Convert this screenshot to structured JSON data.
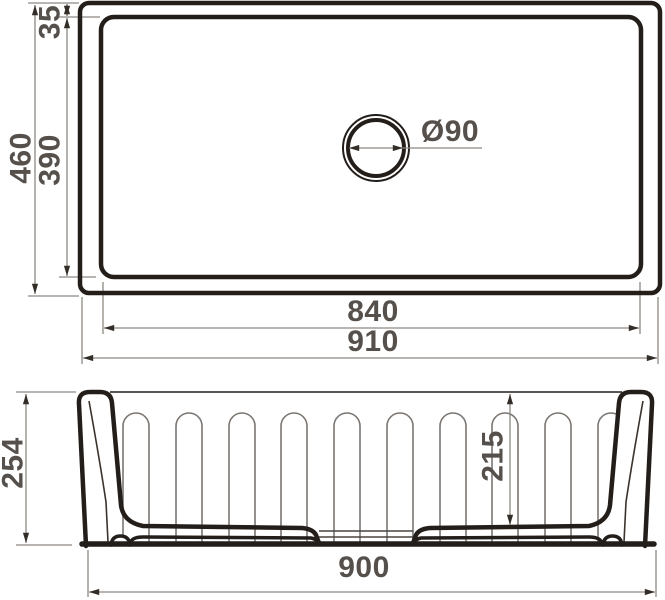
{
  "top_view": {
    "height_total": "460",
    "height_inner": "390",
    "rim_offset": "35",
    "drain_diameter": "Ø90",
    "width_inner": "840",
    "width_total": "910"
  },
  "front_view": {
    "height_total": "254",
    "depth_inner": "215",
    "width_bottom": "900"
  },
  "colors": {
    "object_line": "#241e1a",
    "dimension_line": "#8d8883",
    "arrowhead": "#332d28",
    "label_text": "#55504b",
    "background": "#ffffff"
  }
}
